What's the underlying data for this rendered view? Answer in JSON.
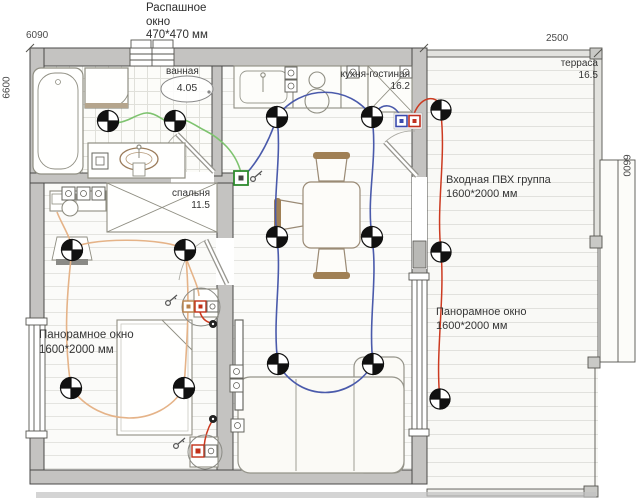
{
  "labels": {
    "swing_window": {
      "line1": "Распашное",
      "line2": "окно",
      "line3": "470*470 мм"
    },
    "entry_group": {
      "line1": "Входная ПВХ группа",
      "line2": "1600*2000 мм"
    },
    "pano_window_left": {
      "line1": "Панорамное окно",
      "line2": "1600*2000 мм"
    },
    "pano_window_right": {
      "line1": "Панорамное окно",
      "line2": "1600*2000 мм"
    }
  },
  "dimensions": {
    "top_left": "6090",
    "top_right": "2500",
    "left": "6600",
    "right": "6600"
  },
  "rooms": {
    "bathroom": {
      "name": "ванная",
      "area": "4.05"
    },
    "kitchen_living": {
      "name": "кухня-гостиная",
      "area": "16.2"
    },
    "bedroom": {
      "name": "спальня",
      "area": "11.5"
    },
    "terrace": {
      "name": "терраса",
      "area": "16.5"
    }
  },
  "colors": {
    "wall": "#c4c3c1",
    "wire_bathroom_green": "#7ec36f",
    "wire_living_blue": "#4a5aab",
    "wire_bedroom_orange": "#e5b388",
    "wire_power_red": "#cc3a20",
    "wood_accent": "#a08055"
  }
}
